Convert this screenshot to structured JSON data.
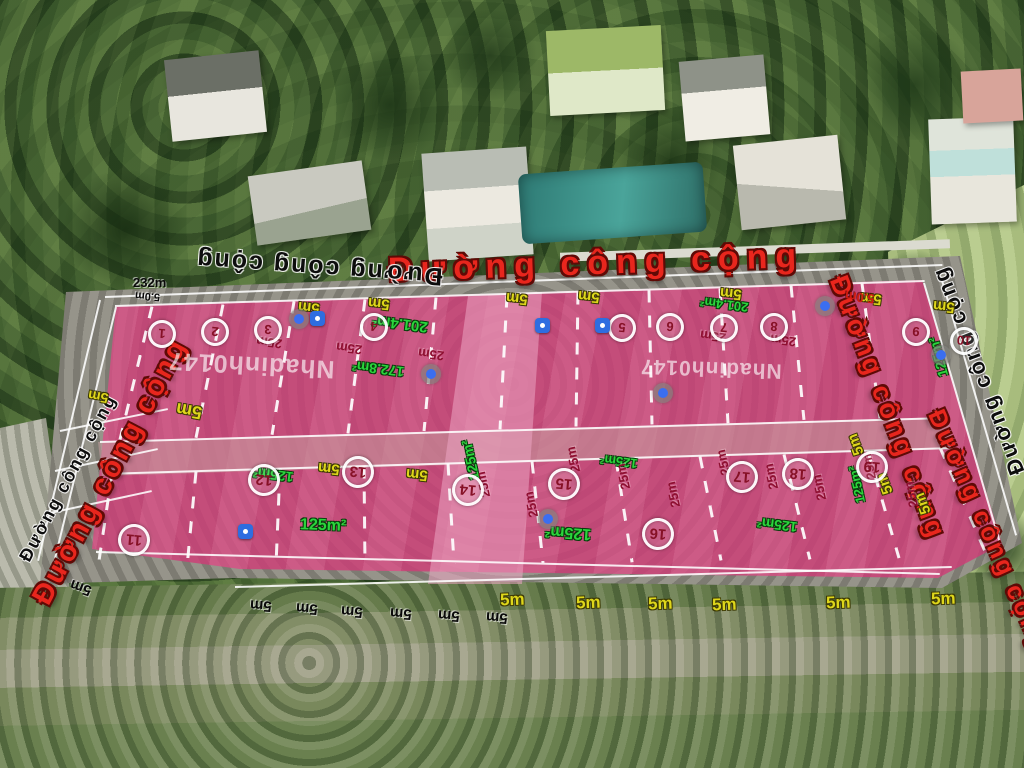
{
  "roads": {
    "label": "Đường công cộng"
  },
  "watermark": {
    "text": "Nhadinh0147"
  },
  "areas": {
    "standard": "125m²",
    "large": "201.4m²",
    "medium": "172.8m²"
  },
  "dimensions": {
    "lot_width": "5m",
    "lot_depth": "25m",
    "frontage": "232m",
    "road_width": "5.0m"
  },
  "plots": {
    "top_row": [
      "1",
      "2",
      "3",
      "4",
      "5",
      "6",
      "7",
      "8",
      "9",
      "10"
    ],
    "bottom_row": [
      "11",
      "12",
      "13",
      "14",
      "15",
      "16",
      "17",
      "18",
      "19"
    ]
  }
}
